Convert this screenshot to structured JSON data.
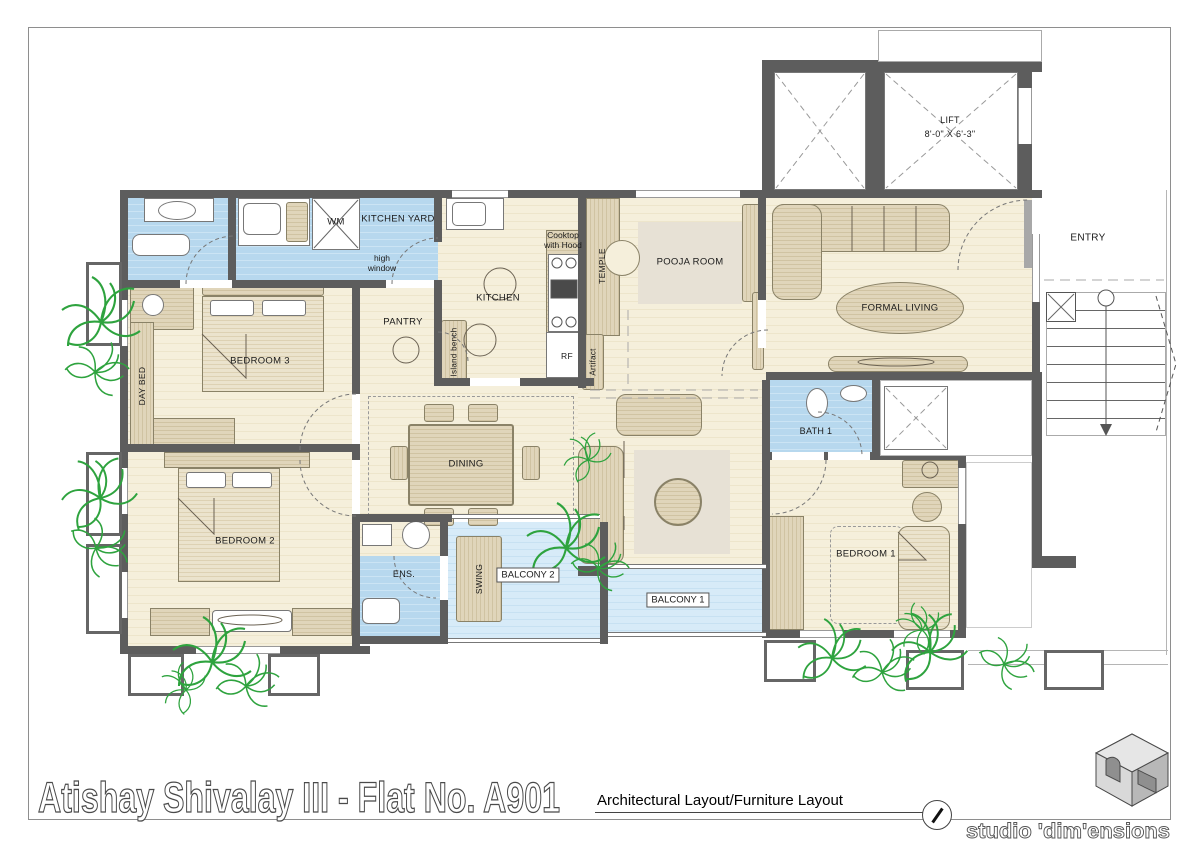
{
  "page": {
    "title": "Atishay Shivalay III - Flat No. A901",
    "subtitle": "Architectural Layout/Furniture Layout",
    "studio": "studio 'dim'ensions"
  },
  "colors": {
    "wall": "#5d5d5d",
    "room_floor": "#f5efdb",
    "wet_floor": "#b7d8ee",
    "balcony_floor": "#d7ebf8",
    "furniture": "#d9cdae",
    "plant": "#2ea33e",
    "rug": "#e7e1d5"
  },
  "labels": {
    "lift": "LIFT",
    "lift_size": "8'-0\" X 6'-3\"",
    "entry": "ENTRY",
    "kitchen_yard": "KITCHEN YARD",
    "wm": "WM",
    "high_window": "high window",
    "pantry": "PANTRY",
    "kitchen": "KITCHEN",
    "cooktop": "Cooktop with Hood",
    "temple": "TEMPLE",
    "pooja": "POOJA ROOM",
    "formal_living": "FORMAL LIVING",
    "bedroom3": "BEDROOM 3",
    "day_bed": "DAY BED",
    "dining": "DINING",
    "island_bench": "Island bench",
    "rf": "RF",
    "artifact": "Artifact",
    "bath1": "BATH 1",
    "bedroom2": "BEDROOM 2",
    "ens": "ENS.",
    "swing": "SWING",
    "balcony2": "BALCONY 2",
    "balcony1": "BALCONY 1",
    "bedroom1": "BEDROOM 1"
  }
}
